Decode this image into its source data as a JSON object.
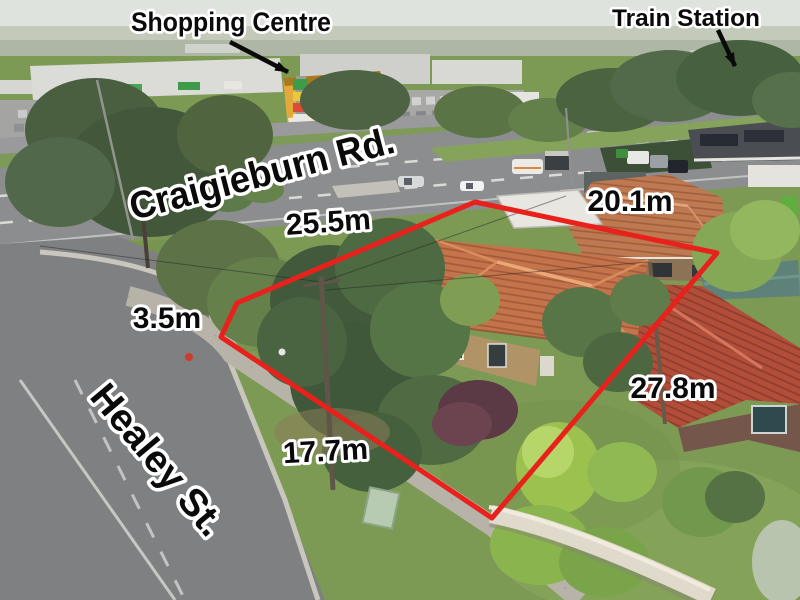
{
  "photo": {
    "type": "aerial-property-photo",
    "poi_labels": {
      "shopping_centre": "Shopping Centre",
      "train_station": "Train Station"
    },
    "street_labels": {
      "main_road": "Craigieburn Rd.",
      "side_street": "Healey St."
    },
    "boundary_measurements": {
      "north_frontage": "25.5m",
      "north_east": "20.1m",
      "corner_splay": "3.5m",
      "south_east": "27.8m",
      "side_street_frontage": "17.7m"
    },
    "colors": {
      "boundary_line": "#e8211d",
      "label_fill": "#0a0a0a",
      "label_outline": "#ffffff"
    }
  }
}
